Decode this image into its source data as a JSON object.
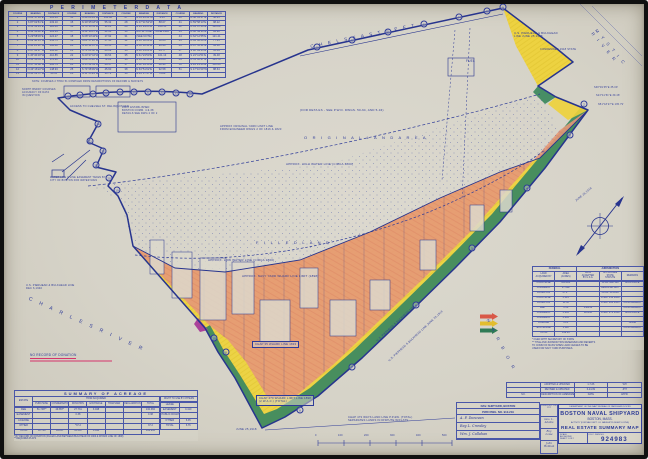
{
  "colors": {
    "paper": "#d8d5ca",
    "ink": "#2e3b99",
    "boundary": "#27348e",
    "fill_pink": "#e69878",
    "fill_yellow": "#eed23a",
    "fill_green": "#3f8a60",
    "fill_magenta": "#a83a98",
    "arrow_red": "#d95848",
    "arrow_yellow": "#e2bd2f",
    "arrow_green": "#2f7a55",
    "underline_red": "#d6336b"
  },
  "perimeter": {
    "title": "P E R I M E T E R    D A T A",
    "note": "NOTE: COURSES 2 THRU 51 COMPILED FROM DESCRIPTIONS OF RECORD & SURVEYS",
    "rows": [
      [
        "COURSE",
        "BEARING",
        "DISTANCE",
        "COURSE",
        "BEARING",
        "DISTANCE",
        "COURSE",
        "BEARING",
        "DISTANCE",
        "COURSE",
        "BEARING",
        "DISTANCE"
      ],
      [
        "1",
        "N 61°17'12″E",
        "105.63",
        "14",
        "S 48°26'33″W",
        "141.86",
        "27",
        "N 53°23'41″W",
        "9.41",
        "40",
        "N 58°01'27″E",
        "46.25"
      ],
      [
        "2",
        "S 87°02'51″E",
        "233.10",
        "15",
        "N 39°25'18″W",
        "55.32",
        "28",
        "N 07°11'52″W",
        "88.07",
        "41",
        "N 59°58'13″E",
        "98.22"
      ],
      [
        "3",
        "S 51°33'14″E",
        "120.46",
        "16",
        "N 70°14'51″W",
        "31.26",
        "29",
        "N 14°29'05″E",
        "120.55",
        "42",
        "N 61°07'44″E",
        "110.08"
      ],
      [
        "4",
        "S 42°50'42″E",
        "181.34",
        "17",
        "N 52°18'17″E",
        "21.66",
        "30",
        "M.L.W. LINE",
        "JUNE 1918",
        "43",
        "N 60°49'36″E",
        "84.90"
      ],
      [
        "5",
        "S 29°58'06″E",
        "224.27",
        "18",
        "N 08°10'42″E",
        "17.92",
        "31",
        "(SEE NOTE)",
        "",
        "44",
        "N 62°12'55″E",
        "121.41"
      ],
      [
        "6",
        "S 39°48'14″W",
        "252.71",
        "19",
        "S 81°17'26″W",
        "57.38",
        "32",
        "N 46°30'09″E",
        "58.64",
        "45",
        "N 64°02'08″E",
        "77.35"
      ],
      [
        "7",
        "S 44°25'31″W",
        "586.48",
        "20",
        "N 18°41'07″W",
        "44.15",
        "33",
        "N 50°12'44″E",
        "96.40",
        "46",
        "N 67°55'21″E",
        "64.18"
      ],
      [
        "8",
        "S 47°52'17″W",
        "394.62",
        "21",
        "S 71°03'58″W",
        "63.09",
        "34",
        "N 60°41'23″E",
        "84.77",
        "47",
        "S 38°49'35″E",
        "35.09"
      ],
      [
        "9",
        "S 45°36'49″W",
        "410.85",
        "22",
        "N 20°27'16″W",
        "39.54",
        "35",
        "N 61°23'50″E",
        "101.13",
        "48",
        "S 23°41'51″E",
        "39.48"
      ],
      [
        "10",
        "N 44°48'55″W",
        "178.20",
        "23",
        "S 68°55'40″W",
        "72.81",
        "36",
        "N 61°58'36″E",
        "95.06",
        "49",
        "N 51°18'27″E",
        "135.79"
      ],
      [
        "11",
        "N 47°31'08″W",
        "206.74",
        "24",
        "N 15°02'33″W",
        "28.47",
        "37",
        "N 62°44'18″E",
        "88.93",
        "50",
        "S 44°21'46″E",
        "150.26"
      ],
      [
        "12",
        "N 43°16'22″W",
        "148.93",
        "25",
        "S 74°38'09″W",
        "45.60",
        "38",
        "N 63°51'02″E",
        "92.58",
        "51",
        "S 47°10'30″W",
        "88.64"
      ],
      [
        "13",
        "N 40°02'57″W",
        "96.31",
        "26",
        "N 11°55'24″W",
        "33.72",
        "39",
        "N 64°17'47″E",
        "79.82",
        "",
        "",
        ""
      ]
    ]
  },
  "legend": {
    "header_left": "FEDERAL",
    "header_right": "JURISDICTION",
    "col_headers": [
      "LAND\nACQUIRED BY",
      "AREA\n(ACRES)",
      "DATE\nACCEPTED\nBY U.S.A.",
      "APPLICABLE\nSTATE\nSTATUTE",
      "REMARKS"
    ],
    "rows": [
      [
        "PURCHASE",
        "109.284",
        "",
        "CHAPTER 128",
        "EXCLUSIVE"
      ],
      [
        "CONDEMN.",
        "27.482",
        "",
        "RESOLVE 1867",
        "″"
      ],
      [
        "DONATION",
        "37.2 *",
        "",
        "CHAP. 58 1866",
        "″"
      ],
      [
        "PURCHASE",
        "3.325",
        "",
        "CHAP. 152 1868",
        "″"
      ],
      [
        "DONATION",
        "11.36",
        "",
        "CHAP. 404 1935",
        "CONCURRENT"
      ],
      [
        "FEE **",
        "0.38",
        "1/28/36",
        "",
        "CONCURRENT"
      ],
      [
        "CONDEMN.",
        "5.285",
        "11/6/18",
        "CHAP. 271 1918",
        "EXCLUSIVE"
      ],
      [
        "CONDEMN.",
        "2.285",
        "",
        "″",
        "″"
      ],
      [
        "LICENSE",
        "0.21",
        "",
        "",
        "NONE"
      ],
      [
        "EXCHANGE",
        "3.118",
        "",
        "",
        "CONCURRENT"
      ],
      [
        "TOTAL",
        "199.93",
        "",
        "",
        ""
      ]
    ],
    "notes": [
      "* FILED WITH SECRETARY OF STATE",
      "** TITLE AND JURISDICTION RESERVED AND REVERTS",
      "   TO COMM OF MASS WHEN LAND CEASES TO BE",
      "   USED FOR NAVY YARD PURPOSES."
    ]
  },
  "acreage": {
    "title": "SUMMARY OF ACREAGE",
    "group_header": "HOW ACQUIRED",
    "col_headers": [
      "ESTATE",
      "PURCHASE",
      "CONDEMNATION",
      "DONATION",
      "EXCHANGE",
      "TRANSFER",
      "RECLAMATION",
      "TOTAL"
    ],
    "right_header": "RIGHT TO USE BY OTHERS",
    "rows": [
      [
        "FEE",
        "51.748**",
        "49.857*",
        "27.731",
        "3.048",
        "",
        "",
        "132.384"
      ],
      [
        "EASEMENT",
        "",
        "",
        "0.38",
        "",
        "",
        "",
        "0.38"
      ],
      [
        "LICENSE",
        "",
        "",
        "",
        "",
        "",
        "",
        ""
      ],
      [
        "OTHER",
        "",
        "",
        "*37.2",
        "",
        "",
        "",
        "37.2"
      ],
      [
        "TOTAL",
        "51.748",
        "49.857",
        "65.311",
        "3.048",
        "",
        "",
        "169.964"
      ]
    ],
    "right_rows": [
      [
        "LEASE",
        ""
      ],
      [
        "EASEMENT",
        "0.410"
      ],
      [
        "PUBLIC ROADS",
        ""
      ],
      [
        "OTHER",
        "6.35"
      ],
      [
        "TOTAL",
        "6.76"
      ]
    ],
    "footnotes": [
      "*  BY RECORD OF DONATION (FILLED LAND BETWEEN BULKHEAD OF 1900 & WHARF LINE OF 1898)",
      "** REQUIRES PLATS"
    ]
  },
  "revisions": {
    "rows": [
      [
        "",
        "ADOPTED & UPDATED",
        "1-7-66",
        "WH"
      ],
      [
        "",
        "REVISED & UPDATED",
        "6-24-69",
        "JHT"
      ],
      [
        "NO.",
        "DESCRIPTION OF AMENDMENT OR CORRECTION",
        "DATE",
        "APPR."
      ]
    ]
  },
  "dwg_block": {
    "title1": "NAV. SHIPYARD, BOSTON",
    "title2": "PWD DWG. NO. 912-219",
    "signatures": [
      "A. F. Donovan",
      "Ray L. Crowley",
      "Wm. J. Callahan"
    ],
    "right_title": "DPWO NO. YE-217",
    "right_signatures": [
      "Geo. L. Adams",
      "Roy Lowe",
      "John Holman"
    ]
  },
  "title_block": {
    "department": "DEPARTMENT OF THE NAVY      BUREAU OF YARDS AND DOCKS",
    "yard": "BOSTON NAVAL SHIPYARD",
    "city": "BOSTON, MASS.",
    "activity": "ACTIVITY (FOR NAV. DEPT. C/L NAVSHIPYD MGMT LOCNS)",
    "map_title": "REAL ESTATE SUMMARY MAP",
    "scale_label": "SCALE",
    "scale_value": "AS SHOWN",
    "sheet": "SHEET 1 OF 2",
    "fsc_label": "F.S.C. DWG NO.",
    "number": "924983"
  },
  "map": {
    "labels": [
      {
        "t": "C H E L S E A     S T R E E T",
        "x": 306,
        "y": 40,
        "s": 4.5,
        "r": -11.5,
        "cls": "sp"
      },
      {
        "t": "M Y S T I C   R I V E R",
        "x": 594,
        "y": 24,
        "s": 4.2,
        "r": 50,
        "cls": "sp"
      },
      {
        "t": "U.S. PIERHEAD & BULKHEAD\nLINE JUNE 25,1918",
        "x": 510,
        "y": 28,
        "s": 2.8
      },
      {
        "t": "CONDEMNED 1918 STATE",
        "x": 536,
        "y": 44,
        "s": 2.6
      },
      {
        "t": "S38°49'35″E  35.09'",
        "x": 590,
        "y": 82,
        "s": 2.4
      },
      {
        "t": "S23°41'51″E  39.48'",
        "x": 592,
        "y": 90,
        "s": 2.4
      },
      {
        "t": "N51°18'27″E  135.79'",
        "x": 594,
        "y": 99,
        "s": 2.4
      },
      {
        "t": "JUNE 25,1918",
        "x": 571,
        "y": 196,
        "s": 2.8,
        "r": -40
      },
      {
        "t": "FUEL",
        "x": 462,
        "y": 55,
        "s": 3.2
      },
      {
        "t": "(FOR DETAILS - SEE P.W.D. DWGS. 50-64, AND 5-34)",
        "x": 296,
        "y": 105,
        "s": 3
      },
      {
        "t": "APPROX ORIGINAL YARD LIMIT LINE\nFROM ENGINEER DWGS 2 OF 1816 & 1823",
        "x": 216,
        "y": 121,
        "s": 2.7
      },
      {
        "t": "O R I G I N A L    L A N D    A R E A",
        "x": 300,
        "y": 131,
        "s": 4,
        "cls": "sp"
      },
      {
        "t": "APPROX. HIGH WATER LINE (CIRCA 1800)",
        "x": 282,
        "y": 159,
        "s": 3
      },
      {
        "t": "F I L L E D    L A N D",
        "x": 252,
        "y": 236,
        "s": 4,
        "cls": "sp"
      },
      {
        "t": "APPROX. LOW WATER LINE (CIRCA 1800)",
        "x": 204,
        "y": 255,
        "s": 3
      },
      {
        "t": "APPROX. NAVY YARD WHARF LINE LIMIT (1898)",
        "x": 238,
        "y": 271,
        "s": 3
      },
      {
        "t": "ACCESS TO CHELSEA ST. RELINQUISHED",
        "x": 66,
        "y": 101,
        "s": 2.6
      },
      {
        "t": "LIMIT ESTABLISHED\nBOSTON COMM. 4-9-38\nDETAILS SEE DWG 2 OF 2",
        "x": 118,
        "y": 102,
        "s": 2.5
      },
      {
        "t": "NORTH BNDRY COURSES\nACCURACY OF DATA\nIN QUESTION",
        "x": 18,
        "y": 84,
        "s": 2.4
      },
      {
        "t": "WATER LINE & LINE EASEMENT TAKEN BY\nCITY OF BOSTON FOR WATER MAIN",
        "x": 46,
        "y": 172,
        "s": 2.4
      },
      {
        "t": "U.S. PIERHEAD & BULKHEAD LINE\nDEC 6,1940",
        "x": 22,
        "y": 280,
        "s": 2.6
      },
      {
        "t": "NO RECORD OF DONATION",
        "x": 26,
        "y": 349,
        "s": 3.2,
        "cls": "ured"
      },
      {
        "t": "C H A R L E S    R I V E R",
        "x": 26,
        "y": 292,
        "s": 5,
        "r": 24,
        "cls": "sp2"
      },
      {
        "t": "CHAP 35 WHARF LINE 1833",
        "x": 248,
        "y": 337,
        "s": 2.8,
        "cls": "boxed"
      },
      {
        "t": "CHAP 470 WHARF LIMIT LINE 1898\n(2 W.A.C.) (TOTAL)",
        "x": 252,
        "y": 391,
        "s": 2.8,
        "cls": "boxed"
      },
      {
        "t": "U.S. PIERHEAD & BULKHEAD LINE",
        "x": 372,
        "y": 336,
        "s": 2.8,
        "r": -43
      },
      {
        "t": "U.S. PIERHEAD & BULKHEAD LINE JUNE 25,1918",
        "x": 384,
        "y": 356,
        "s": 2.8,
        "r": -43
      },
      {
        "t": "CHAP 473 WAYS LAND LINE P.P.&W. (TOTAL)\nSEPARATES LANDS IN DISPUTE W/FLATS",
        "x": 344,
        "y": 412,
        "s": 2.7
      },
      {
        "t": "JUNE 25,1918",
        "x": 232,
        "y": 424,
        "s": 2.8
      },
      {
        "t": "H A R B O R",
        "x": 486,
        "y": 314,
        "s": 4.2,
        "r": 62,
        "cls": "sp2"
      },
      {
        "t": "0",
        "x": 311,
        "y": 430,
        "s": 2.5
      },
      {
        "t": "100",
        "x": 334,
        "y": 430,
        "s": 2.5
      },
      {
        "t": "200",
        "x": 360,
        "y": 430,
        "s": 2.5
      },
      {
        "t": "300",
        "x": 386,
        "y": 430,
        "s": 2.5
      },
      {
        "t": "400",
        "x": 412,
        "y": 430,
        "s": 2.5
      },
      {
        "t": "500",
        "x": 438,
        "y": 430,
        "s": 2.5
      },
      {
        "t": "NOTE: COURSES 2 THRU 51 COMPILED FROM DESCRIPTIONS OF RECORD & SURVEYS",
        "x": 28,
        "y": 77,
        "s": 2.3
      }
    ],
    "course_markers": [
      {
        "n": "1",
        "x": 499,
        "y": 3
      },
      {
        "n": "45",
        "x": 483,
        "y": 7
      },
      {
        "n": "44",
        "x": 455,
        "y": 13
      },
      {
        "n": "43",
        "x": 420,
        "y": 20
      },
      {
        "n": "42",
        "x": 384,
        "y": 28
      },
      {
        "n": "41",
        "x": 348,
        "y": 36
      },
      {
        "n": "40",
        "x": 313,
        "y": 43
      },
      {
        "n": "34",
        "x": 186,
        "y": 90
      },
      {
        "n": "33",
        "x": 172,
        "y": 89
      },
      {
        "n": "32",
        "x": 158,
        "y": 88
      },
      {
        "n": "31",
        "x": 144,
        "y": 88
      },
      {
        "n": "30",
        "x": 130,
        "y": 88
      },
      {
        "n": "29",
        "x": 116,
        "y": 88
      },
      {
        "n": "28",
        "x": 102,
        "y": 89
      },
      {
        "n": "27",
        "x": 89,
        "y": 90
      },
      {
        "n": "26",
        "x": 76,
        "y": 91
      },
      {
        "n": "25",
        "x": 64,
        "y": 92
      },
      {
        "n": "24",
        "x": 94,
        "y": 120
      },
      {
        "n": "23",
        "x": 86,
        "y": 137
      },
      {
        "n": "22",
        "x": 99,
        "y": 147
      },
      {
        "n": "21",
        "x": 92,
        "y": 161
      },
      {
        "n": "20",
        "x": 105,
        "y": 174
      },
      {
        "n": "19",
        "x": 113,
        "y": 186
      },
      {
        "n": "2",
        "x": 580,
        "y": 100
      },
      {
        "n": "3",
        "x": 566,
        "y": 131
      },
      {
        "n": "4",
        "x": 523,
        "y": 184
      },
      {
        "n": "5",
        "x": 468,
        "y": 244
      },
      {
        "n": "6",
        "x": 412,
        "y": 301
      },
      {
        "n": "7",
        "x": 348,
        "y": 363
      },
      {
        "n": "8",
        "x": 296,
        "y": 406
      },
      {
        "n": "9",
        "x": 222,
        "y": 348
      },
      {
        "n": "10",
        "x": 210,
        "y": 334
      }
    ]
  }
}
